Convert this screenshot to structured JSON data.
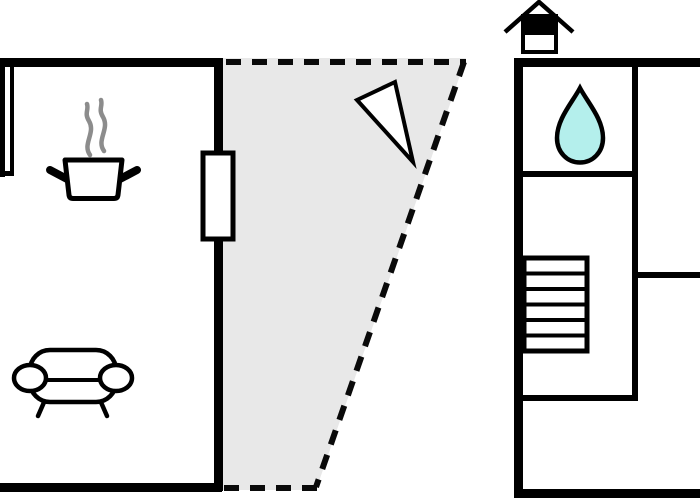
{
  "page": {
    "title": "Floor plan",
    "width": 700,
    "height": 500,
    "background": "#ffffff"
  },
  "colors": {
    "wall": "#000000",
    "terrace_fill": "#e8e8e8",
    "dash_stroke": "#0a0a0a",
    "water_drop_fill": "#b4efec",
    "steam_stroke": "#8c8c8c",
    "icon_fill": "#ffffff"
  },
  "plan": {
    "left_unit": {
      "outline": "solid black walls, open at left image edge",
      "icons": [
        {
          "name": "cooking-pot-icon",
          "depicts": "steaming cooking pot"
        },
        {
          "name": "sofa-icon",
          "depicts": "two-arm sofa"
        }
      ],
      "openings": [
        {
          "name": "door-marker",
          "depicts": "door/window rectangle on right wall"
        }
      ]
    },
    "terrace": {
      "outline": "dashed boundary, gray shaded trapezoid",
      "icons": [
        {
          "name": "view-direction-triangle-icon",
          "depicts": "narrow triangle pointer"
        }
      ]
    },
    "right_unit": {
      "outline": "solid black walls, cut off at right image edge",
      "icons": [
        {
          "name": "water-drop-icon",
          "depicts": "water drop (wet room)"
        },
        {
          "name": "stairs-icon",
          "depicts": "staircase",
          "steps": 6
        },
        {
          "name": "house-chimney-icon",
          "depicts": "small house symbol above outer wall"
        }
      ]
    }
  }
}
